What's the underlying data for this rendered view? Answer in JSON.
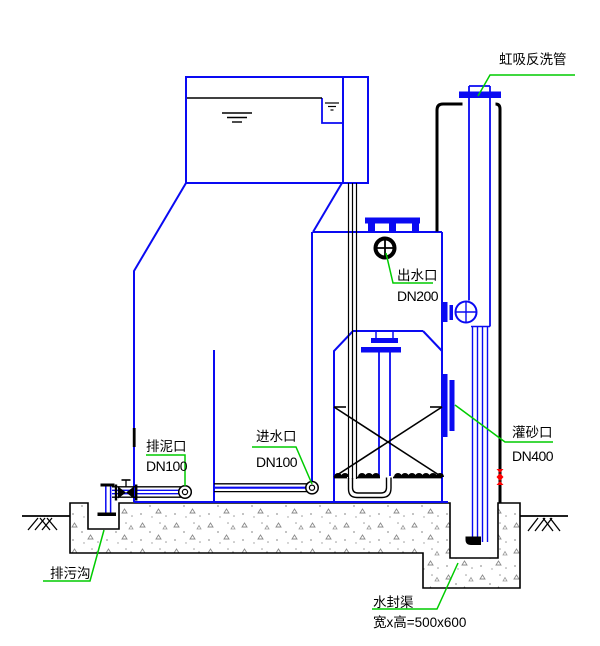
{
  "diagram": {
    "type": "engineering-drawing",
    "subject": "siphon filter tank cross-section",
    "labels": {
      "siphon_backwash_pipe": "虹吸反洗管",
      "outlet_port": "出水口",
      "outlet_size": "DN200",
      "sludge_port": "排泥口",
      "sludge_size": "DN100",
      "inlet_port": "进水口",
      "inlet_size": "DN100",
      "sand_port": "灌砂口",
      "sand_size": "DN400",
      "sewage_ditch": "排污沟",
      "water_seal_channel": "水封渠",
      "water_seal_dimension": "宽x高=500x600"
    },
    "colors": {
      "structure_blue": "#0a0af2",
      "pipe_black": "#000000",
      "leader_green": "#00cc00",
      "valve_red": "#ff0000",
      "concrete_gray": "#8a8a8a",
      "background": "#ffffff"
    }
  }
}
